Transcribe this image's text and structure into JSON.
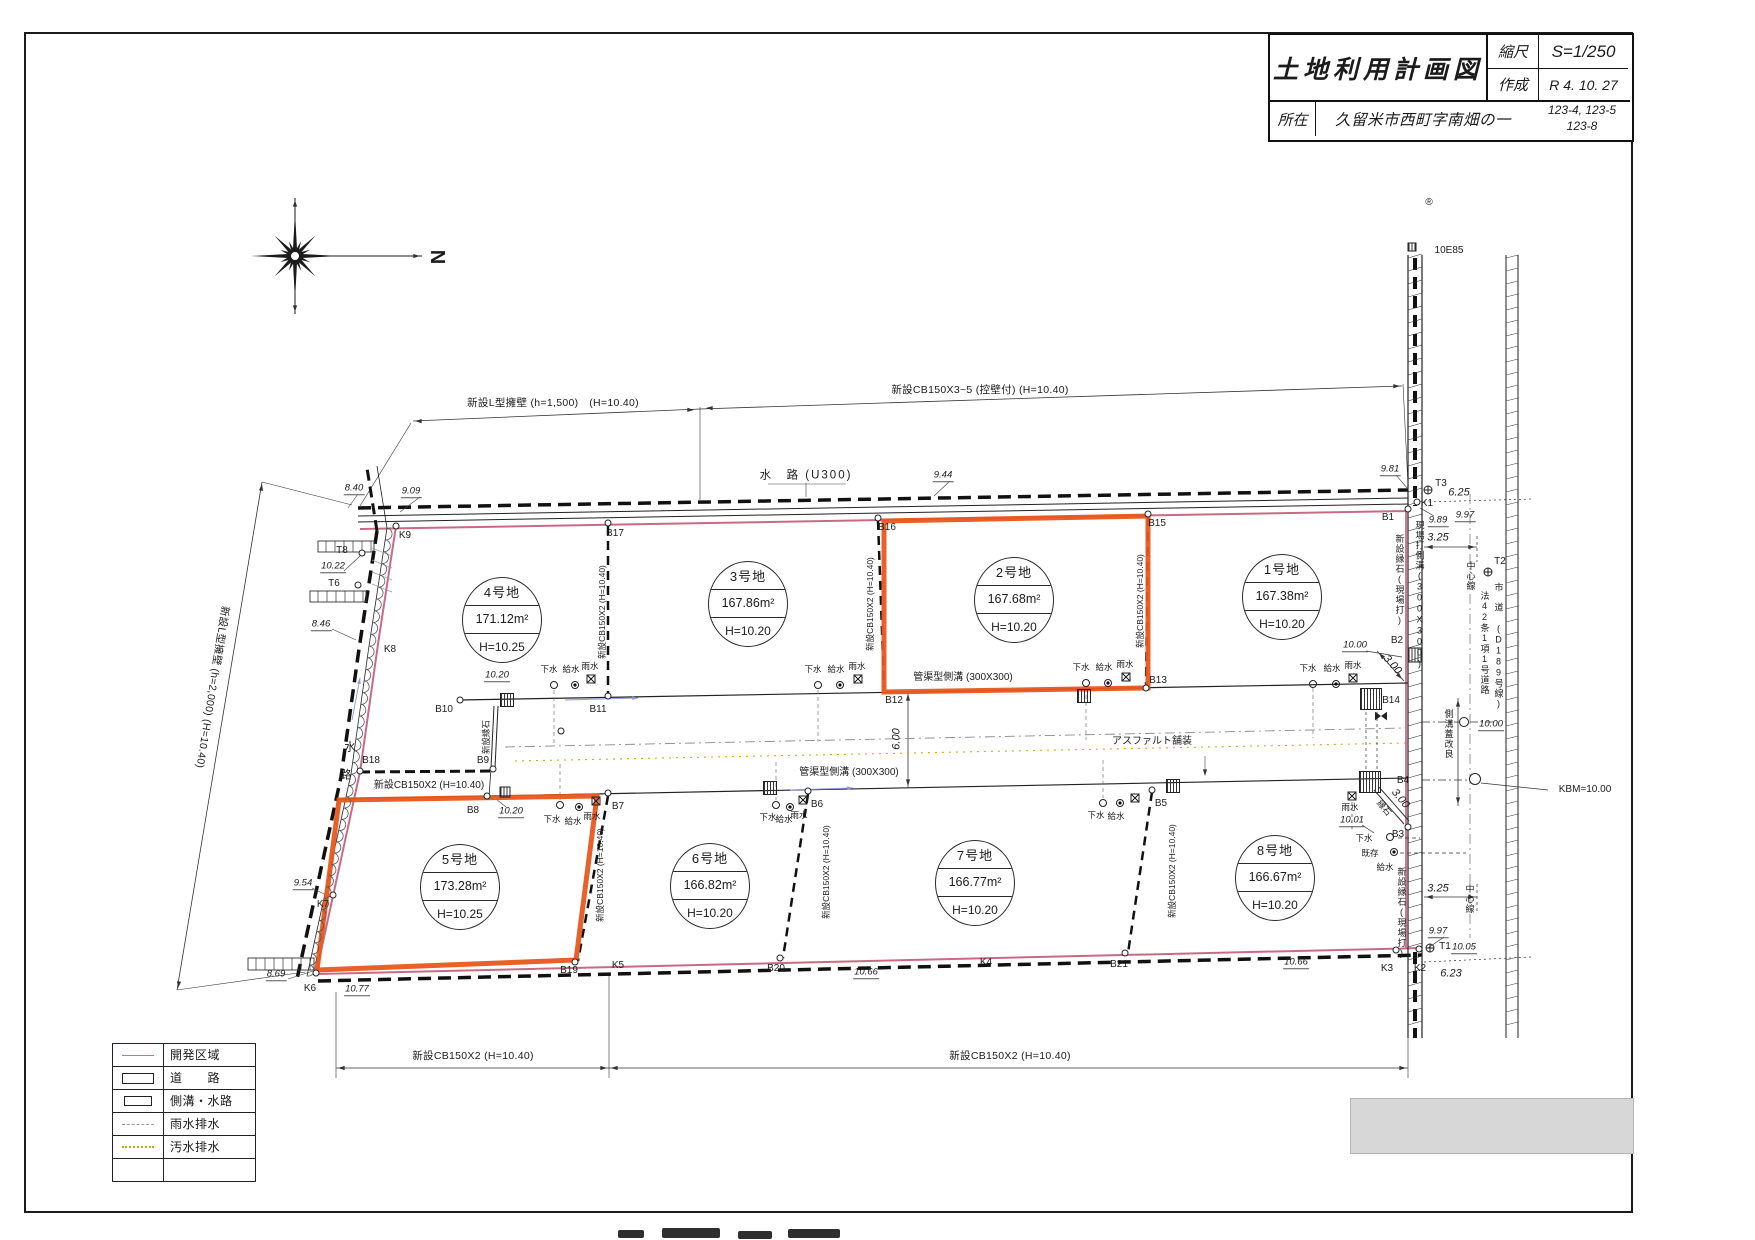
{
  "title_block": {
    "title": "土地利用計画図",
    "scale_label": "縮尺",
    "scale_value": "S=1/250",
    "made_label": "作成",
    "made_value": "R 4. 10.  27",
    "location_label": "所在",
    "location_value": "久留米市西町字南畑の一",
    "parcels_line1": "123-4, 123-5",
    "parcels_line2": "123-8"
  },
  "compass": {
    "north": "N"
  },
  "colors": {
    "highlight_orange": "#e8571c",
    "boundary_pink": "#c96a85",
    "sewage_yellow": "#d8a21a",
    "rain_gray": "#999999",
    "ink": "#1b1b1b",
    "flow_blue": "#8898d8"
  },
  "legend": [
    {
      "sym": "boundary",
      "label": "開発区域"
    },
    {
      "sym": "road",
      "label": "道　　路"
    },
    {
      "sym": "ditch",
      "label": "側溝・水路"
    },
    {
      "sym": "rain",
      "label": "雨水排水"
    },
    {
      "sym": "sewage",
      "label": "汚水排水"
    },
    {
      "sym": "none",
      "label": ""
    }
  ],
  "lots": [
    {
      "name": "1号地",
      "area": "167.38m²",
      "height": "H=10.20",
      "cx": 1282,
      "cy": 597,
      "highlighted": false
    },
    {
      "name": "2号地",
      "area": "167.68m²",
      "height": "H=10.20",
      "cx": 1014,
      "cy": 600,
      "highlighted": true
    },
    {
      "name": "3号地",
      "area": "167.86m²",
      "height": "H=10.20",
      "cx": 748,
      "cy": 604,
      "highlighted": false
    },
    {
      "name": "4号地",
      "area": "171.12m²",
      "height": "H=10.25",
      "cx": 502,
      "cy": 620,
      "highlighted": false
    },
    {
      "name": "5号地",
      "area": "173.28m²",
      "height": "H=10.25",
      "cx": 460,
      "cy": 887,
      "highlighted": true
    },
    {
      "name": "6号地",
      "area": "166.82m²",
      "height": "H=10.20",
      "cx": 710,
      "cy": 886,
      "highlighted": false
    },
    {
      "name": "7号地",
      "area": "166.77m²",
      "height": "H=10.20",
      "cx": 975,
      "cy": 883,
      "highlighted": false
    },
    {
      "name": "8号地",
      "area": "166.67m²",
      "height": "H=10.20",
      "cx": 1275,
      "cy": 878,
      "highlighted": false
    }
  ],
  "texts": [
    {
      "t": "®",
      "x": 1429,
      "y": 203,
      "c": "pt",
      "n": "registration-mark"
    },
    {
      "t": "10E85",
      "x": 1449,
      "y": 251,
      "c": "pt"
    },
    {
      "t": "N",
      "x": 437,
      "y": 257,
      "c": "north",
      "r": 90,
      "n": "compass-north-label"
    },
    {
      "t": "新設L型擁壁 (h=1,500)　(H=10.40)",
      "x": 553,
      "y": 403,
      "c": "an"
    },
    {
      "t": "新設CB150X3~5 (控壁付) (H=10.40)",
      "x": 980,
      "y": 390,
      "c": "an"
    },
    {
      "t": "水　路 (U300)",
      "x": 806,
      "y": 476,
      "c": "an2"
    },
    {
      "t": "9.09",
      "x": 411,
      "y": 492,
      "c": "sp"
    },
    {
      "t": "8.40",
      "x": 354,
      "y": 489,
      "c": "sp"
    },
    {
      "t": "9.44",
      "x": 943,
      "y": 476,
      "c": "sp"
    },
    {
      "t": "9.81",
      "x": 1390,
      "y": 470,
      "c": "sp"
    },
    {
      "t": "K9",
      "x": 405,
      "y": 536,
      "c": "pt"
    },
    {
      "t": "B17",
      "x": 615,
      "y": 534,
      "c": "pt"
    },
    {
      "t": "B16",
      "x": 887,
      "y": 528,
      "c": "pt"
    },
    {
      "t": "B15",
      "x": 1157,
      "y": 524,
      "c": "pt"
    },
    {
      "t": "B1",
      "x": 1388,
      "y": 518,
      "c": "pt"
    },
    {
      "t": "K1",
      "x": 1427,
      "y": 504,
      "c": "pt"
    },
    {
      "t": "T3",
      "x": 1441,
      "y": 484,
      "c": "pt"
    },
    {
      "t": "6.25",
      "x": 1459,
      "y": 493,
      "c": "dm"
    },
    {
      "t": "9.89",
      "x": 1438,
      "y": 521,
      "c": "sp"
    },
    {
      "t": "9.97",
      "x": 1465,
      "y": 516,
      "c": "sp"
    },
    {
      "t": "3.25",
      "x": 1438,
      "y": 538,
      "c": "dm"
    },
    {
      "t": "T2",
      "x": 1500,
      "y": 562,
      "c": "pt"
    },
    {
      "t": "中心線",
      "x": 1470,
      "y": 576,
      "c": "vert"
    },
    {
      "t": "新設縁石(現場打)",
      "x": 1399,
      "y": 580,
      "c": "vert"
    },
    {
      "t": "現場打側溝(300X300)",
      "x": 1419,
      "y": 595,
      "c": "vert"
    },
    {
      "t": "法42条1項1号道路",
      "x": 1484,
      "y": 643,
      "c": "vert"
    },
    {
      "t": "市　道 (D189号線)",
      "x": 1498,
      "y": 646,
      "c": "vert"
    },
    {
      "t": "T8",
      "x": 342,
      "y": 551,
      "c": "pt"
    },
    {
      "t": "10.22",
      "x": 333,
      "y": 567,
      "c": "sp"
    },
    {
      "t": "T6",
      "x": 334,
      "y": 584,
      "c": "pt"
    },
    {
      "t": "8.46",
      "x": 321,
      "y": 625,
      "c": "sp"
    },
    {
      "t": "K8",
      "x": 390,
      "y": 650,
      "c": "pt"
    },
    {
      "t": "水",
      "x": 351,
      "y": 748,
      "c": "an2"
    },
    {
      "t": "路",
      "x": 347,
      "y": 776,
      "c": "an2"
    },
    {
      "t": "B18",
      "x": 371,
      "y": 761,
      "c": "pt"
    },
    {
      "t": "新設CB150X2 (H=10.40)",
      "x": 429,
      "y": 786,
      "c": "an3"
    },
    {
      "t": "9.54",
      "x": 303,
      "y": 884,
      "c": "sp"
    },
    {
      "t": "K7",
      "x": 323,
      "y": 905,
      "c": "pt"
    },
    {
      "t": "8.69",
      "x": 276,
      "y": 975,
      "c": "sp"
    },
    {
      "t": "K6",
      "x": 310,
      "y": 989,
      "c": "pt"
    },
    {
      "t": "10.77",
      "x": 357,
      "y": 990,
      "c": "sp"
    },
    {
      "t": "新設L型擁壁 (h=2,000) (H=10.40)",
      "x": 212,
      "y": 687,
      "c": "an",
      "r": 99
    },
    {
      "t": "新設CB150X2 (H=10.40)",
      "x": 602,
      "y": 612,
      "c": "rv",
      "r": -90
    },
    {
      "t": "新設CB150X2 (H=10.40)",
      "x": 870,
      "y": 604,
      "c": "rv",
      "r": -90
    },
    {
      "t": "新設CB150X2 (H=10.40)",
      "x": 1140,
      "y": 601,
      "c": "rv",
      "r": -90
    },
    {
      "t": "新設CB150X2 (H=10.40)",
      "x": 600,
      "y": 875,
      "c": "rv",
      "r": -90
    },
    {
      "t": "新設CB150X2 (H=10.40)",
      "x": 826,
      "y": 872,
      "c": "rv",
      "r": -90
    },
    {
      "t": "新設CB150X2 (H=10.40)",
      "x": 1172,
      "y": 871,
      "c": "rv",
      "r": -90
    },
    {
      "t": "新設縁石",
      "x": 486,
      "y": 737,
      "c": "rv",
      "r": -90
    },
    {
      "t": "B10",
      "x": 444,
      "y": 710,
      "c": "pt"
    },
    {
      "t": "10.20",
      "x": 497,
      "y": 676,
      "c": "sp"
    },
    {
      "t": "B11",
      "x": 598,
      "y": 710,
      "c": "pt"
    },
    {
      "t": "B12",
      "x": 894,
      "y": 701,
      "c": "pt"
    },
    {
      "t": "B13",
      "x": 1158,
      "y": 681,
      "c": "pt"
    },
    {
      "t": "B14",
      "x": 1391,
      "y": 701,
      "c": "pt"
    },
    {
      "t": "管渠型側溝 (300X300)",
      "x": 963,
      "y": 678,
      "c": "an3"
    },
    {
      "t": "管渠型側溝 (300X300)",
      "x": 849,
      "y": 773,
      "c": "an3"
    },
    {
      "t": "6.00",
      "x": 897,
      "y": 739,
      "c": "dm",
      "r": -90
    },
    {
      "t": "アスファルト舗装",
      "x": 1152,
      "y": 742,
      "c": "an3"
    },
    {
      "t": "B9",
      "x": 483,
      "y": 761,
      "c": "pt"
    },
    {
      "t": "B8",
      "x": 473,
      "y": 811,
      "c": "pt"
    },
    {
      "t": "10.20",
      "x": 511,
      "y": 812,
      "c": "sp"
    },
    {
      "t": "B7",
      "x": 618,
      "y": 807,
      "c": "pt"
    },
    {
      "t": "B6",
      "x": 817,
      "y": 805,
      "c": "pt"
    },
    {
      "t": "B5",
      "x": 1161,
      "y": 804,
      "c": "pt"
    },
    {
      "t": "下水",
      "x": 549,
      "y": 669,
      "c": "ut"
    },
    {
      "t": "給水",
      "x": 571,
      "y": 669,
      "c": "ut"
    },
    {
      "t": "雨水",
      "x": 590,
      "y": 666,
      "c": "ut"
    },
    {
      "t": "下水",
      "x": 813,
      "y": 669,
      "c": "ut"
    },
    {
      "t": "給水",
      "x": 836,
      "y": 669,
      "c": "ut"
    },
    {
      "t": "雨水",
      "x": 857,
      "y": 666,
      "c": "ut"
    },
    {
      "t": "下水",
      "x": 1081,
      "y": 667,
      "c": "ut"
    },
    {
      "t": "給水",
      "x": 1104,
      "y": 667,
      "c": "ut"
    },
    {
      "t": "雨水",
      "x": 1125,
      "y": 664,
      "c": "ut"
    },
    {
      "t": "下水",
      "x": 1308,
      "y": 668,
      "c": "ut"
    },
    {
      "t": "給水",
      "x": 1332,
      "y": 668,
      "c": "ut"
    },
    {
      "t": "雨水",
      "x": 1353,
      "y": 665,
      "c": "ut"
    },
    {
      "t": "下水",
      "x": 552,
      "y": 819,
      "c": "ut"
    },
    {
      "t": "給水",
      "x": 573,
      "y": 821,
      "c": "ut"
    },
    {
      "t": "雨水",
      "x": 592,
      "y": 816,
      "c": "ut"
    },
    {
      "t": "下水",
      "x": 768,
      "y": 817,
      "c": "ut"
    },
    {
      "t": "給水",
      "x": 784,
      "y": 819,
      "c": "ut"
    },
    {
      "t": "雨水",
      "x": 799,
      "y": 815,
      "c": "ut"
    },
    {
      "t": "下水",
      "x": 1096,
      "y": 815,
      "c": "ut"
    },
    {
      "t": "給水",
      "x": 1116,
      "y": 816,
      "c": "ut"
    },
    {
      "t": "B2",
      "x": 1397,
      "y": 641,
      "c": "pt"
    },
    {
      "t": "10.00",
      "x": 1355,
      "y": 646,
      "c": "sp"
    },
    {
      "t": "3.00",
      "x": 1392,
      "y": 665,
      "c": "dm",
      "r": 48
    },
    {
      "t": "側溝蓋改良",
      "x": 1448,
      "y": 734,
      "c": "vert"
    },
    {
      "t": "10.00",
      "x": 1491,
      "y": 725,
      "c": "sp"
    },
    {
      "t": "KBM=10.00",
      "x": 1585,
      "y": 790,
      "c": "an3"
    },
    {
      "t": "B4",
      "x": 1403,
      "y": 781,
      "c": "pt"
    },
    {
      "t": "3.00",
      "x": 1400,
      "y": 799,
      "c": "dm",
      "r": 50
    },
    {
      "t": "縁石",
      "x": 1384,
      "y": 808,
      "c": "ut",
      "r": 50
    },
    {
      "t": "B3",
      "x": 1398,
      "y": 835,
      "c": "pt"
    },
    {
      "t": "雨水",
      "x": 1350,
      "y": 807,
      "c": "ut"
    },
    {
      "t": "10.01",
      "x": 1352,
      "y": 821,
      "c": "sp"
    },
    {
      "t": "下水",
      "x": 1364,
      "y": 838,
      "c": "ut"
    },
    {
      "t": "既存",
      "x": 1370,
      "y": 853,
      "c": "ut"
    },
    {
      "t": "給水",
      "x": 1385,
      "y": 867,
      "c": "ut"
    },
    {
      "t": "3.25",
      "x": 1438,
      "y": 889,
      "c": "dm"
    },
    {
      "t": "中心線",
      "x": 1469,
      "y": 899,
      "c": "vert"
    },
    {
      "t": "新設縁石(現場打)",
      "x": 1401,
      "y": 913,
      "c": "vert"
    },
    {
      "t": "9.97",
      "x": 1438,
      "y": 932,
      "c": "sp"
    },
    {
      "t": "T1",
      "x": 1445,
      "y": 947,
      "c": "pt"
    },
    {
      "t": "10.05",
      "x": 1464,
      "y": 948,
      "c": "sp"
    },
    {
      "t": "K2",
      "x": 1420,
      "y": 969,
      "c": "pt"
    },
    {
      "t": "6.23",
      "x": 1451,
      "y": 974,
      "c": "dm"
    },
    {
      "t": "K3",
      "x": 1387,
      "y": 969,
      "c": "pt"
    },
    {
      "t": "B19",
      "x": 569,
      "y": 971,
      "c": "pt"
    },
    {
      "t": "K5",
      "x": 618,
      "y": 966,
      "c": "pt"
    },
    {
      "t": "B20",
      "x": 776,
      "y": 969,
      "c": "pt"
    },
    {
      "t": "K4",
      "x": 986,
      "y": 963,
      "c": "pt"
    },
    {
      "t": "B21",
      "x": 1119,
      "y": 965,
      "c": "pt"
    },
    {
      "t": "10.66",
      "x": 866,
      "y": 973,
      "c": "sp"
    },
    {
      "t": "10.66",
      "x": 1296,
      "y": 963,
      "c": "sp"
    },
    {
      "t": "新設CB150X2 (H=10.40)",
      "x": 473,
      "y": 1056,
      "c": "an"
    },
    {
      "t": "新設CB150X2 (H=10.40)",
      "x": 1010,
      "y": 1056,
      "c": "an"
    }
  ],
  "symbols": [
    {
      "k": "p",
      "x": 396,
      "y": 526
    },
    {
      "k": "p",
      "x": 608,
      "y": 523
    },
    {
      "k": "p",
      "x": 878,
      "y": 518
    },
    {
      "k": "p",
      "x": 1148,
      "y": 514
    },
    {
      "k": "p",
      "x": 1408,
      "y": 509
    },
    {
      "k": "p",
      "x": 460,
      "y": 700
    },
    {
      "k": "p",
      "x": 608,
      "y": 696
    },
    {
      "k": "p",
      "x": 1146,
      "y": 688
    },
    {
      "k": "p",
      "x": 493,
      "y": 769
    },
    {
      "k": "p",
      "x": 487,
      "y": 796
    },
    {
      "k": "p",
      "x": 608,
      "y": 793
    },
    {
      "k": "p",
      "x": 808,
      "y": 791
    },
    {
      "k": "p",
      "x": 1152,
      "y": 790
    },
    {
      "k": "p",
      "x": 360,
      "y": 771
    },
    {
      "k": "p",
      "x": 333,
      "y": 895
    },
    {
      "k": "p",
      "x": 316,
      "y": 973
    },
    {
      "k": "p",
      "x": 575,
      "y": 962
    },
    {
      "k": "p",
      "x": 780,
      "y": 958
    },
    {
      "k": "p",
      "x": 1125,
      "y": 953
    },
    {
      "k": "p",
      "x": 1396,
      "y": 950
    },
    {
      "k": "p",
      "x": 1419,
      "y": 949
    },
    {
      "k": "p",
      "x": 1417,
      "y": 502
    },
    {
      "k": "p",
      "x": 1408,
      "y": 827
    },
    {
      "k": "p",
      "x": 561,
      "y": 731
    },
    {
      "k": "p",
      "x": 362,
      "y": 553
    },
    {
      "k": "p",
      "x": 358,
      "y": 585
    },
    {
      "k": "p",
      "x": 1464,
      "y": 722,
      "s": 10
    },
    {
      "k": "p",
      "x": 1475,
      "y": 779,
      "s": 12
    },
    {
      "k": "c",
      "x": 554,
      "y": 685
    },
    {
      "k": "c",
      "x": 818,
      "y": 685
    },
    {
      "k": "c",
      "x": 1086,
      "y": 683
    },
    {
      "k": "c",
      "x": 1313,
      "y": 684
    },
    {
      "k": "c",
      "x": 560,
      "y": 805
    },
    {
      "k": "c",
      "x": 776,
      "y": 805
    },
    {
      "k": "c",
      "x": 1103,
      "y": 803
    },
    {
      "k": "c",
      "x": 1390,
      "y": 837
    },
    {
      "k": "d",
      "x": 575,
      "y": 685
    },
    {
      "k": "d",
      "x": 840,
      "y": 685
    },
    {
      "k": "d",
      "x": 1108,
      "y": 683
    },
    {
      "k": "d",
      "x": 1336,
      "y": 684
    },
    {
      "k": "d",
      "x": 579,
      "y": 807
    },
    {
      "k": "d",
      "x": 790,
      "y": 807
    },
    {
      "k": "d",
      "x": 1120,
      "y": 803
    },
    {
      "k": "d",
      "x": 1394,
      "y": 852
    },
    {
      "k": "x",
      "x": 591,
      "y": 679
    },
    {
      "k": "x",
      "x": 858,
      "y": 679
    },
    {
      "k": "x",
      "x": 1126,
      "y": 677
    },
    {
      "k": "x",
      "x": 1353,
      "y": 678
    },
    {
      "k": "x",
      "x": 596,
      "y": 801
    },
    {
      "k": "x",
      "x": 803,
      "y": 800
    },
    {
      "k": "x",
      "x": 1135,
      "y": 798
    },
    {
      "k": "x",
      "x": 1352,
      "y": 796
    },
    {
      "k": "g",
      "x": 507,
      "y": 700,
      "s": 14
    },
    {
      "k": "g",
      "x": 1084,
      "y": 696,
      "s": 14
    },
    {
      "k": "g",
      "x": 770,
      "y": 788,
      "s": 14
    },
    {
      "k": "g",
      "x": 1173,
      "y": 786,
      "s": 14
    },
    {
      "k": "g",
      "x": 505,
      "y": 792,
      "s": 11
    },
    {
      "k": "g",
      "x": 1371,
      "y": 699,
      "s": 22
    },
    {
      "k": "g",
      "x": 1370,
      "y": 782,
      "s": 22
    },
    {
      "k": "g",
      "x": 1415,
      "y": 655,
      "s": 15
    },
    {
      "k": "g",
      "x": 1412,
      "y": 247,
      "s": 9
    },
    {
      "k": "t",
      "x": 1428,
      "y": 490
    },
    {
      "k": "t",
      "x": 1488,
      "y": 572
    },
    {
      "k": "t",
      "x": 1430,
      "y": 948
    },
    {
      "k": "b",
      "x": 1381,
      "y": 716
    }
  ]
}
